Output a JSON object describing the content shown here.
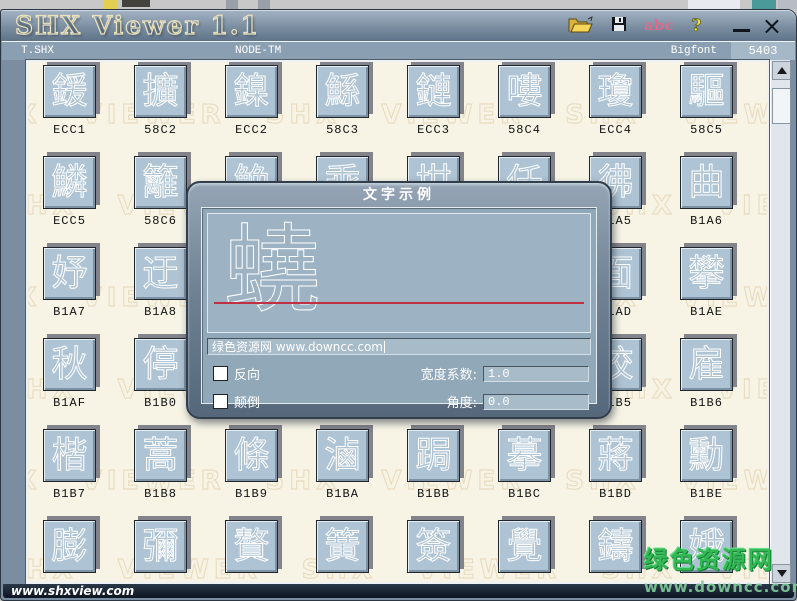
{
  "window": {
    "title": "SHX Viewer 1.1",
    "close_glyph": "×"
  },
  "toolbar": {
    "abc_label": "abc",
    "help_label": "?"
  },
  "header": {
    "file": "T.SHX",
    "font_name": "NODE-TM",
    "font_type": "Bigfont",
    "glyph_count": "5403"
  },
  "watermark": {
    "text": "SHX VIEWER"
  },
  "grid": {
    "rows": [
      {
        "cells": [
          {
            "char": "鍰",
            "code": "ECC1"
          },
          {
            "char": "擴",
            "code": "58C2"
          },
          {
            "char": "鎳",
            "code": "ECC2"
          },
          {
            "char": "鯀",
            "code": "58C3"
          },
          {
            "char": "鏈",
            "code": "ECC3"
          },
          {
            "char": "嘍",
            "code": "58C4"
          },
          {
            "char": "瓊",
            "code": "ECC4"
          },
          {
            "char": "驅",
            "code": "58C5"
          }
        ]
      },
      {
        "cells": [
          {
            "char": "鱗",
            "code": "ECC5"
          },
          {
            "char": "籬",
            "code": "58C6"
          },
          {
            "char": "鮸",
            "code": ""
          },
          {
            "char": "乖",
            "code": ""
          },
          {
            "char": "坩",
            "code": ""
          },
          {
            "char": "仟",
            "code": ""
          },
          {
            "char": "彿",
            "code": "B1A5"
          },
          {
            "char": "曲",
            "code": "B1A6"
          }
        ]
      },
      {
        "cells": [
          {
            "char": "妤",
            "code": "B1A7"
          },
          {
            "char": "迂",
            "code": "B1A8"
          },
          {
            "char": "",
            "code": ""
          },
          {
            "char": "",
            "code": ""
          },
          {
            "char": "",
            "code": ""
          },
          {
            "char": "",
            "code": ""
          },
          {
            "char": "面",
            "code": "B1AD"
          },
          {
            "char": "攀",
            "code": "B1AE"
          }
        ]
      },
      {
        "cells": [
          {
            "char": "秋",
            "code": "B1AF"
          },
          {
            "char": "停",
            "code": "B1B0"
          },
          {
            "char": "",
            "code": ""
          },
          {
            "char": "",
            "code": ""
          },
          {
            "char": "",
            "code": ""
          },
          {
            "char": "",
            "code": ""
          },
          {
            "char": "校",
            "code": "B1B5"
          },
          {
            "char": "雇",
            "code": "B1B6"
          }
        ]
      },
      {
        "cells": [
          {
            "char": "楷",
            "code": "B1B7"
          },
          {
            "char": "蒿",
            "code": "B1B8"
          },
          {
            "char": "條",
            "code": "B1B9"
          },
          {
            "char": "滷",
            "code": "B1BA"
          },
          {
            "char": "跼",
            "code": "B1BB"
          },
          {
            "char": "摹",
            "code": "B1BC"
          },
          {
            "char": "蔣",
            "code": "B1BD"
          },
          {
            "char": "勳",
            "code": "B1BE"
          }
        ]
      },
      {
        "cells": [
          {
            "char": "膨",
            "code": ""
          },
          {
            "char": "彌",
            "code": ""
          },
          {
            "char": "贅",
            "code": ""
          },
          {
            "char": "簧",
            "code": ""
          },
          {
            "char": "簽",
            "code": ""
          },
          {
            "char": "覺",
            "code": ""
          },
          {
            "char": "鑄",
            "code": ""
          },
          {
            "char": "娥",
            "code": ""
          }
        ]
      }
    ]
  },
  "dialog": {
    "title": "文字示例",
    "preview_char": "蟯",
    "sample_text": "绿色资源网 www.downcc.com",
    "option_reverse": "反向",
    "option_flip": "颠倒",
    "width_label": "宽度系数:",
    "width_value": "1.0",
    "angle_label": "角度:",
    "angle_value": "0.0"
  },
  "statusbar": {
    "url": "www.shxview.com"
  },
  "site_watermark": {
    "name": "绿色资源网",
    "url": "www.downcc.com"
  },
  "colors": {
    "button_face": "#aec3d3",
    "background": "#f7f4e6",
    "titlebar": "#7b8ea1",
    "red_line": "#c13040",
    "green_accent": "#33b855"
  }
}
